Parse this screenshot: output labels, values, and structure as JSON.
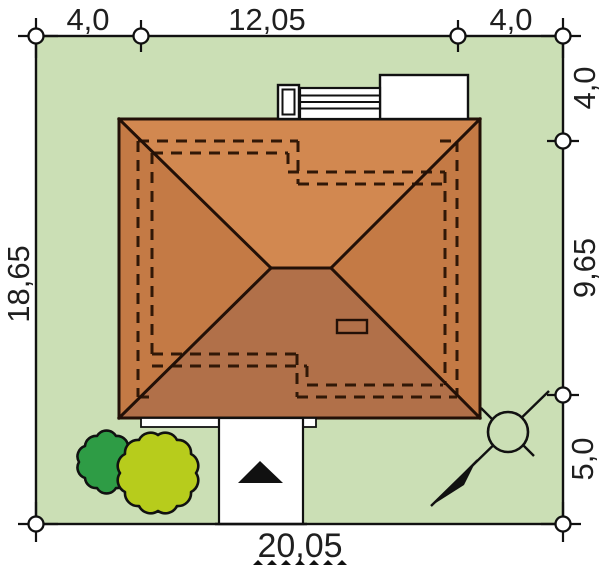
{
  "site_plan": {
    "title": "house site plan",
    "dimension_labels": {
      "top": [
        "4,0",
        "12,05",
        "4,0"
      ],
      "right": [
        "4,0",
        "9,65",
        "5,0"
      ],
      "left": [
        "18,65"
      ],
      "bottom": [
        "20,05"
      ]
    },
    "colors": {
      "plot_green": "#cbdfb5",
      "roof_top": "#d28850",
      "roof_left": "#c47a45",
      "roof_right": "#c47a45",
      "roof_bottom": "#b17049",
      "roof_line": "#221007",
      "wall_dash": "#311807",
      "bush_dark": "#2e9c45",
      "bush_light": "#b7cc1c",
      "white": "#ffffff",
      "ink": "#111111"
    },
    "symbols": {
      "entrance_arrow": "black triangle pointing up (entrance)",
      "north_arrow": "circle with NE-SW needle line",
      "dimension_marker": "small circle on boundary"
    }
  }
}
